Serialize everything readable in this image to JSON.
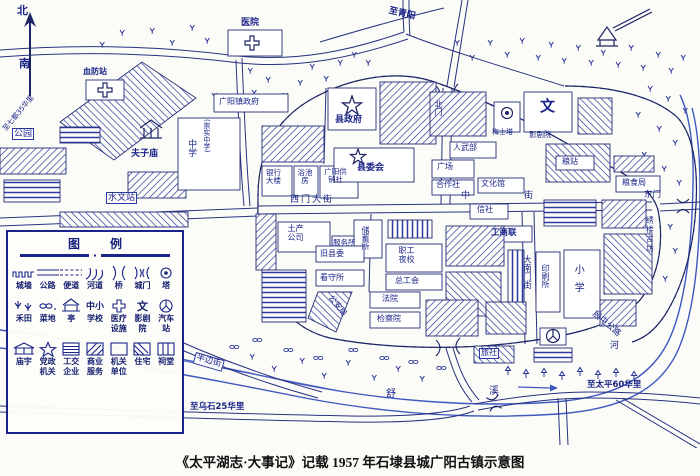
{
  "caption": "《太平湖志·大事记》记载 1957 年石埭县城广阳古镇示意图",
  "map_labels": {
    "north": "北",
    "south": "南",
    "to_qidu": "至七都35华里",
    "xuefang": "血防站",
    "hospital": "医院",
    "to_qingyang": "至青阳",
    "park": "公园",
    "hydro": "水文站",
    "fuzimiao": "夫子庙",
    "middle_school": "中学",
    "chongshi": "(崇实中学)",
    "town_gov": "广阳镇政府",
    "north_gate": "北门",
    "county_gov": "县政府",
    "county_comm": "县委会",
    "plaza": "广场",
    "armed": "人武部",
    "bank": "银行大楼",
    "bath": "浴池房",
    "gongxiao": "广阳供销社",
    "coop": "合作社",
    "culture": "文化馆",
    "grain_station": "粮站",
    "grain_bureau": "粮食局",
    "wen": "文",
    "cinema": "影剧院",
    "pagoda": "梅士塔",
    "west_street": "西门大街",
    "mid_street": "中街",
    "east_gate": "东门",
    "xiulou": "绣楼古坊",
    "tuchan": "土产公司",
    "service": "服务所",
    "savings": "储蓄所",
    "old_comm": "旧县委",
    "detention": "看守所",
    "night_school": "职工夜校",
    "union": "总工会",
    "police": "公安局",
    "court": "法院",
    "procuratorate": "检察院",
    "credit": "信社",
    "federation": "工商联",
    "south_street": "大南门街",
    "printing": "印刷所",
    "primary": "小学",
    "hostel": "旅社",
    "half_street": "半边街",
    "to_wushi": "至乌石25华里",
    "shu": "舒",
    "xi": "溪",
    "he": "河",
    "to_taiping": "至太平60华里",
    "yintun": "殷屯公路"
  },
  "legend": {
    "title": "图例",
    "row1": [
      {
        "label": "城墙"
      },
      {
        "label": "公路"
      },
      {
        "label": "便道"
      },
      {
        "label": "河道"
      },
      {
        "label": "桥"
      },
      {
        "label": "城门"
      },
      {
        "label": "塔"
      }
    ],
    "row2": [
      {
        "label": "禾田"
      },
      {
        "label": "菜地"
      },
      {
        "label": "亭"
      },
      {
        "label": "学校",
        "symtext": "中小"
      },
      {
        "label": "医疗",
        "label2": "设施"
      },
      {
        "label": "影剧",
        "label2": "院",
        "symtext": "文"
      },
      {
        "label": "汽车",
        "label2": "站"
      }
    ],
    "row3": [
      {
        "label": "庙宇"
      },
      {
        "label": "党政",
        "label2": "机关"
      },
      {
        "label": "工交",
        "label2": "企业"
      },
      {
        "label": "商业",
        "label2": "服务"
      },
      {
        "label": "机关",
        "label2": "单位"
      },
      {
        "label": "住宅"
      },
      {
        "label": "祠堂"
      }
    ]
  },
  "ink_colors": {
    "line": "#1c2566",
    "text": "#1a2488",
    "water": "#3f58c0",
    "caption": "#101010"
  }
}
